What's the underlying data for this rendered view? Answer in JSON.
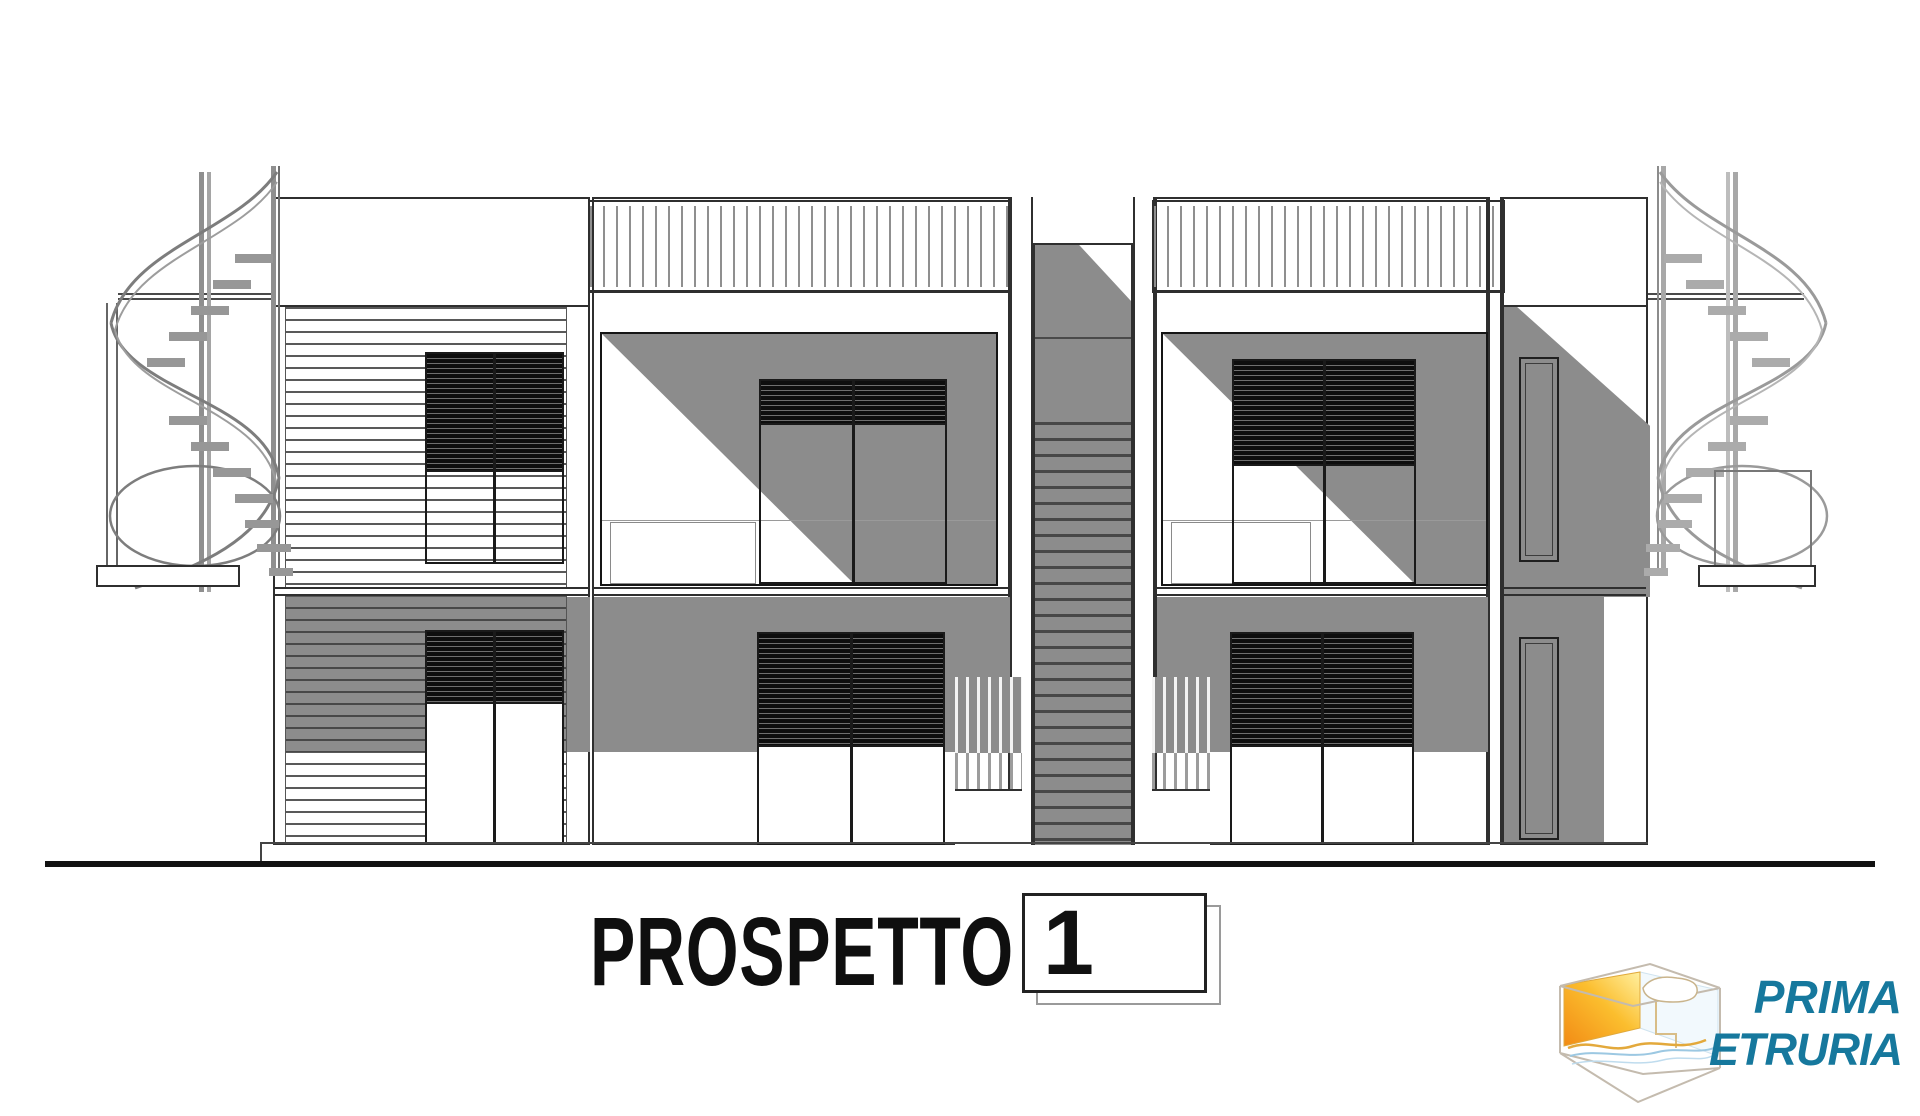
{
  "title": {
    "label": "PROSPETTO",
    "sheet_number": "1"
  },
  "logo": {
    "line1": "PRIMA",
    "line2": "ETRURIA",
    "text_color": "#16789D"
  },
  "drawing": {
    "type": "architectural-elevation",
    "elements": [
      "left-spiral-staircase",
      "left-balcony-slab",
      "louvered-facade-left-unit",
      "window-with-blinds-upper",
      "window-with-blinds-lower",
      "roof-railing-left",
      "roof-railing-right",
      "recessed-balcony-left",
      "recessed-balcony-right",
      "sliding-door-with-blinds",
      "central-stair-tower",
      "slat-fence-left",
      "slat-fence-right",
      "side-wing-with-narrow-doors",
      "right-spiral-staircase",
      "right-balcony-slab",
      "building-base-line",
      "ground-line"
    ],
    "colors": {
      "shadow_gray": "#8C8C8C",
      "line_dark": "#2F2F2F",
      "tread_dark": "#474747",
      "logo_teal": "#16789D",
      "logo_orange": "#F59B1E",
      "logo_yellow": "#FFE477",
      "logo_blue": "#9CC8E2"
    }
  }
}
